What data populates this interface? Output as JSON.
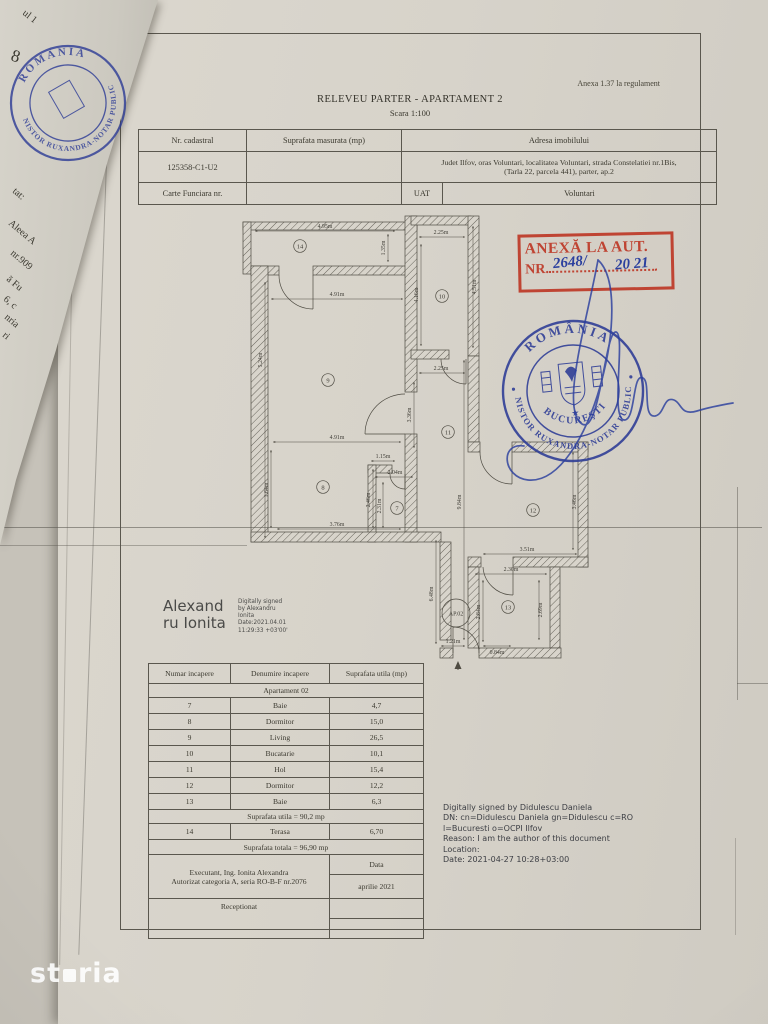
{
  "brand": {
    "watermark_st": "st",
    "watermark_ria": "ria"
  },
  "document": {
    "annex_note": "Anexa 1.37 la regulament",
    "title": "RELEVEU PARTER - APARTAMENT 2",
    "scale": "Scara 1:100"
  },
  "header_table": {
    "col_cadastral": "Nr. cadastral",
    "col_area": "Suprafata masurata (mp)",
    "col_address": "Adresa imobilului",
    "cadastral_value": "125358-C1-U2",
    "address_line1": "Judet Ilfov, oras Voluntari, localitatea Voluntari, strada Constelatiei nr.1Bis,",
    "address_line2": "(Tarla 22, parcela 441), parter, ap.2",
    "cf_label": "Carte Funciara nr.",
    "uat_label": "UAT",
    "uat_value": "Voluntari"
  },
  "annex_stamp": {
    "line1": "ANEXĂ LA AUT.",
    "nr_label": "NR.",
    "number": "2648/",
    "year": "20 21",
    "color": "#bf4433",
    "ink_color": "#2b3f9e"
  },
  "notary_stamp": {
    "country": "ROMÂNIA",
    "ring": "NISTOR RUXANDRA-NOTAR PUBLIC",
    "city": "BUCUREŞTI",
    "star": "★",
    "color": "#2c3b96"
  },
  "floor_plan": {
    "ap_label": "AP.02",
    "rooms": {
      "bath1": "7",
      "bed1": "8",
      "living": "9",
      "kitchen": "10",
      "hall": "11",
      "bed2": "12",
      "bath2": "13",
      "terrace": "14"
    },
    "dims": {
      "terrace_w": "4.95m",
      "terrace_d": "1.35m",
      "living_w": "4.91m",
      "living_h": "5.24m",
      "kitchen_w": "2.25m",
      "kitchen_h_left": "4.16m",
      "kitchen_h_right": "4.51m",
      "hall_w": "2.25m",
      "hall_h": "3.36m",
      "bath1_gap": "1.15m",
      "bath1_w": "2.04m",
      "bath1_h_left": "2.46m",
      "bath1_h_right": "2.31m",
      "bed1_w": "4.91m",
      "bed1_h_left": "1.64m",
      "bed1_bottom": "3.76m",
      "total_h": "9.84m",
      "corridor_h": "6.48m",
      "bed2_w": "3.51m",
      "bed2_h": "3.46m",
      "bath2_w": "2.30m",
      "bath2_h_left": "2.84m",
      "bath2_h_right": "2.69m",
      "bath2_bottom": "0.84m",
      "entry_w": "1.21m"
    }
  },
  "signature_ionita": {
    "name_line1": "Alexand",
    "name_line2": "ru Ionita",
    "details": [
      "Digitally signed",
      "by Alexandru",
      "Ionita",
      "Date:2021.04.01",
      "11:29:33 +03'00'"
    ]
  },
  "signature_didulescu": {
    "lines": [
      "Digitally signed by Didulescu Daniela",
      "DN: cn=Didulescu Daniela gn=Didulescu c=RO",
      "l=Bucuresti o=OCPI Ilfov",
      "Reason: I am the author of this document",
      "Location:",
      "Date: 2021-04-27 10:28+03:00"
    ]
  },
  "areas_table": {
    "headers": [
      "Numar incapere",
      "Denumire incapere",
      "Suprafata utila (mp)"
    ],
    "group": "Apartament 02",
    "rows": [
      [
        "7",
        "Baie",
        "4,7"
      ],
      [
        "8",
        "Dormitor",
        "15,0"
      ],
      [
        "9",
        "Living",
        "26,5"
      ],
      [
        "10",
        "Bucatarie",
        "10,1"
      ],
      [
        "11",
        "Hol",
        "15,4"
      ],
      [
        "12",
        "Dormitor",
        "12,2"
      ],
      [
        "13",
        "Baie",
        "6,3"
      ]
    ],
    "subtotal": "Suprafata utila = 90,2 mp",
    "terrace_row": [
      "14",
      "Terasa",
      "6,70"
    ],
    "total": "Suprafata totala = 96,90 mp",
    "executant_line1": "Executant,  Ing. Ionita Alexandra",
    "executant_line2": "Autorizat categoria A, seria RO-B-F nr.2076",
    "date_label": "Data",
    "date_value": "aprilie 2021",
    "received_label": "Receptionat"
  },
  "fold_fragments": [
    "ul 1",
    "8",
    "tat:",
    "Aleea A",
    "nr.909",
    "ă Fu",
    "6, c",
    "nria",
    "ri"
  ]
}
